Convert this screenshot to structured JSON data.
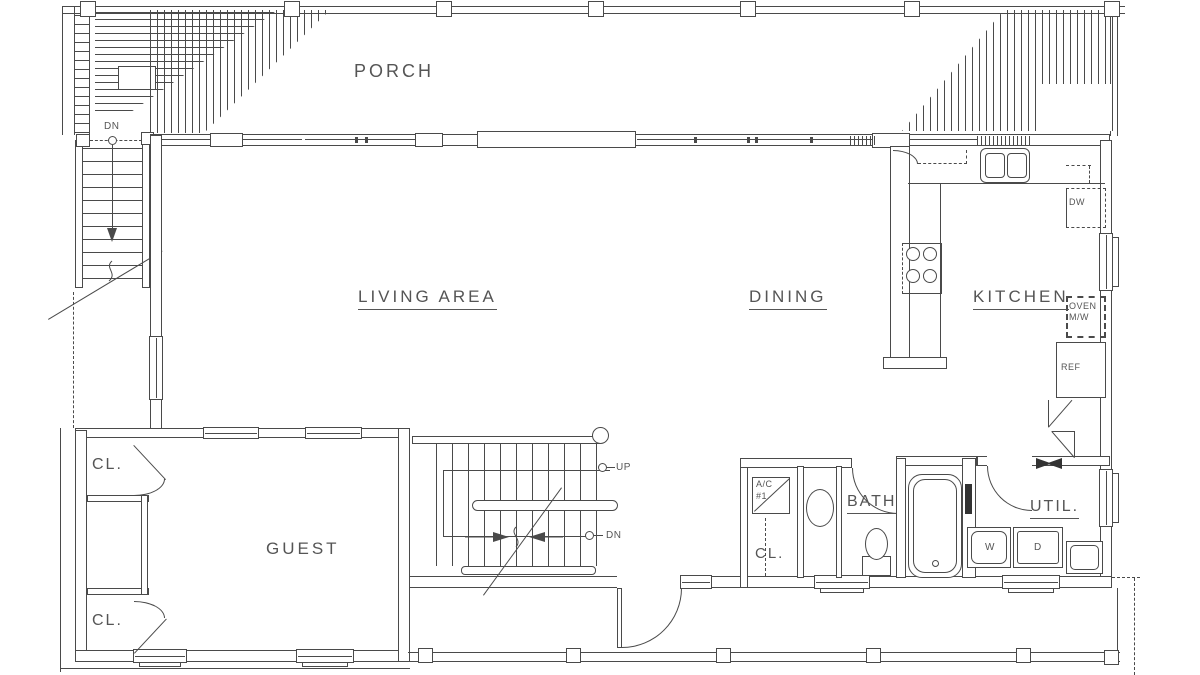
{
  "plan": {
    "background": "#ffffff",
    "line_color": "#4a4a4a",
    "text_color": "#555555",
    "rooms": {
      "porch": "PORCH",
      "living_area": "LIVING AREA",
      "dining": "DINING",
      "kitchen": "KITCHEN",
      "guest": "GUEST",
      "bath": "BATH",
      "utility": "UTIL."
    },
    "closets": {
      "guest_upper": "CL.",
      "guest_lower": "CL.",
      "hall": "CL."
    },
    "equipment": {
      "ac_unit_line1": "A/C",
      "ac_unit_line2": "#1",
      "dishwasher": "DW",
      "oven_line1": "OVEN",
      "oven_line2": "M/W",
      "refrigerator": "REF",
      "washer": "W",
      "dryer": "D"
    },
    "stairs": {
      "interior_up": "UP",
      "interior_down": "DN",
      "exterior_down": "DN"
    }
  }
}
